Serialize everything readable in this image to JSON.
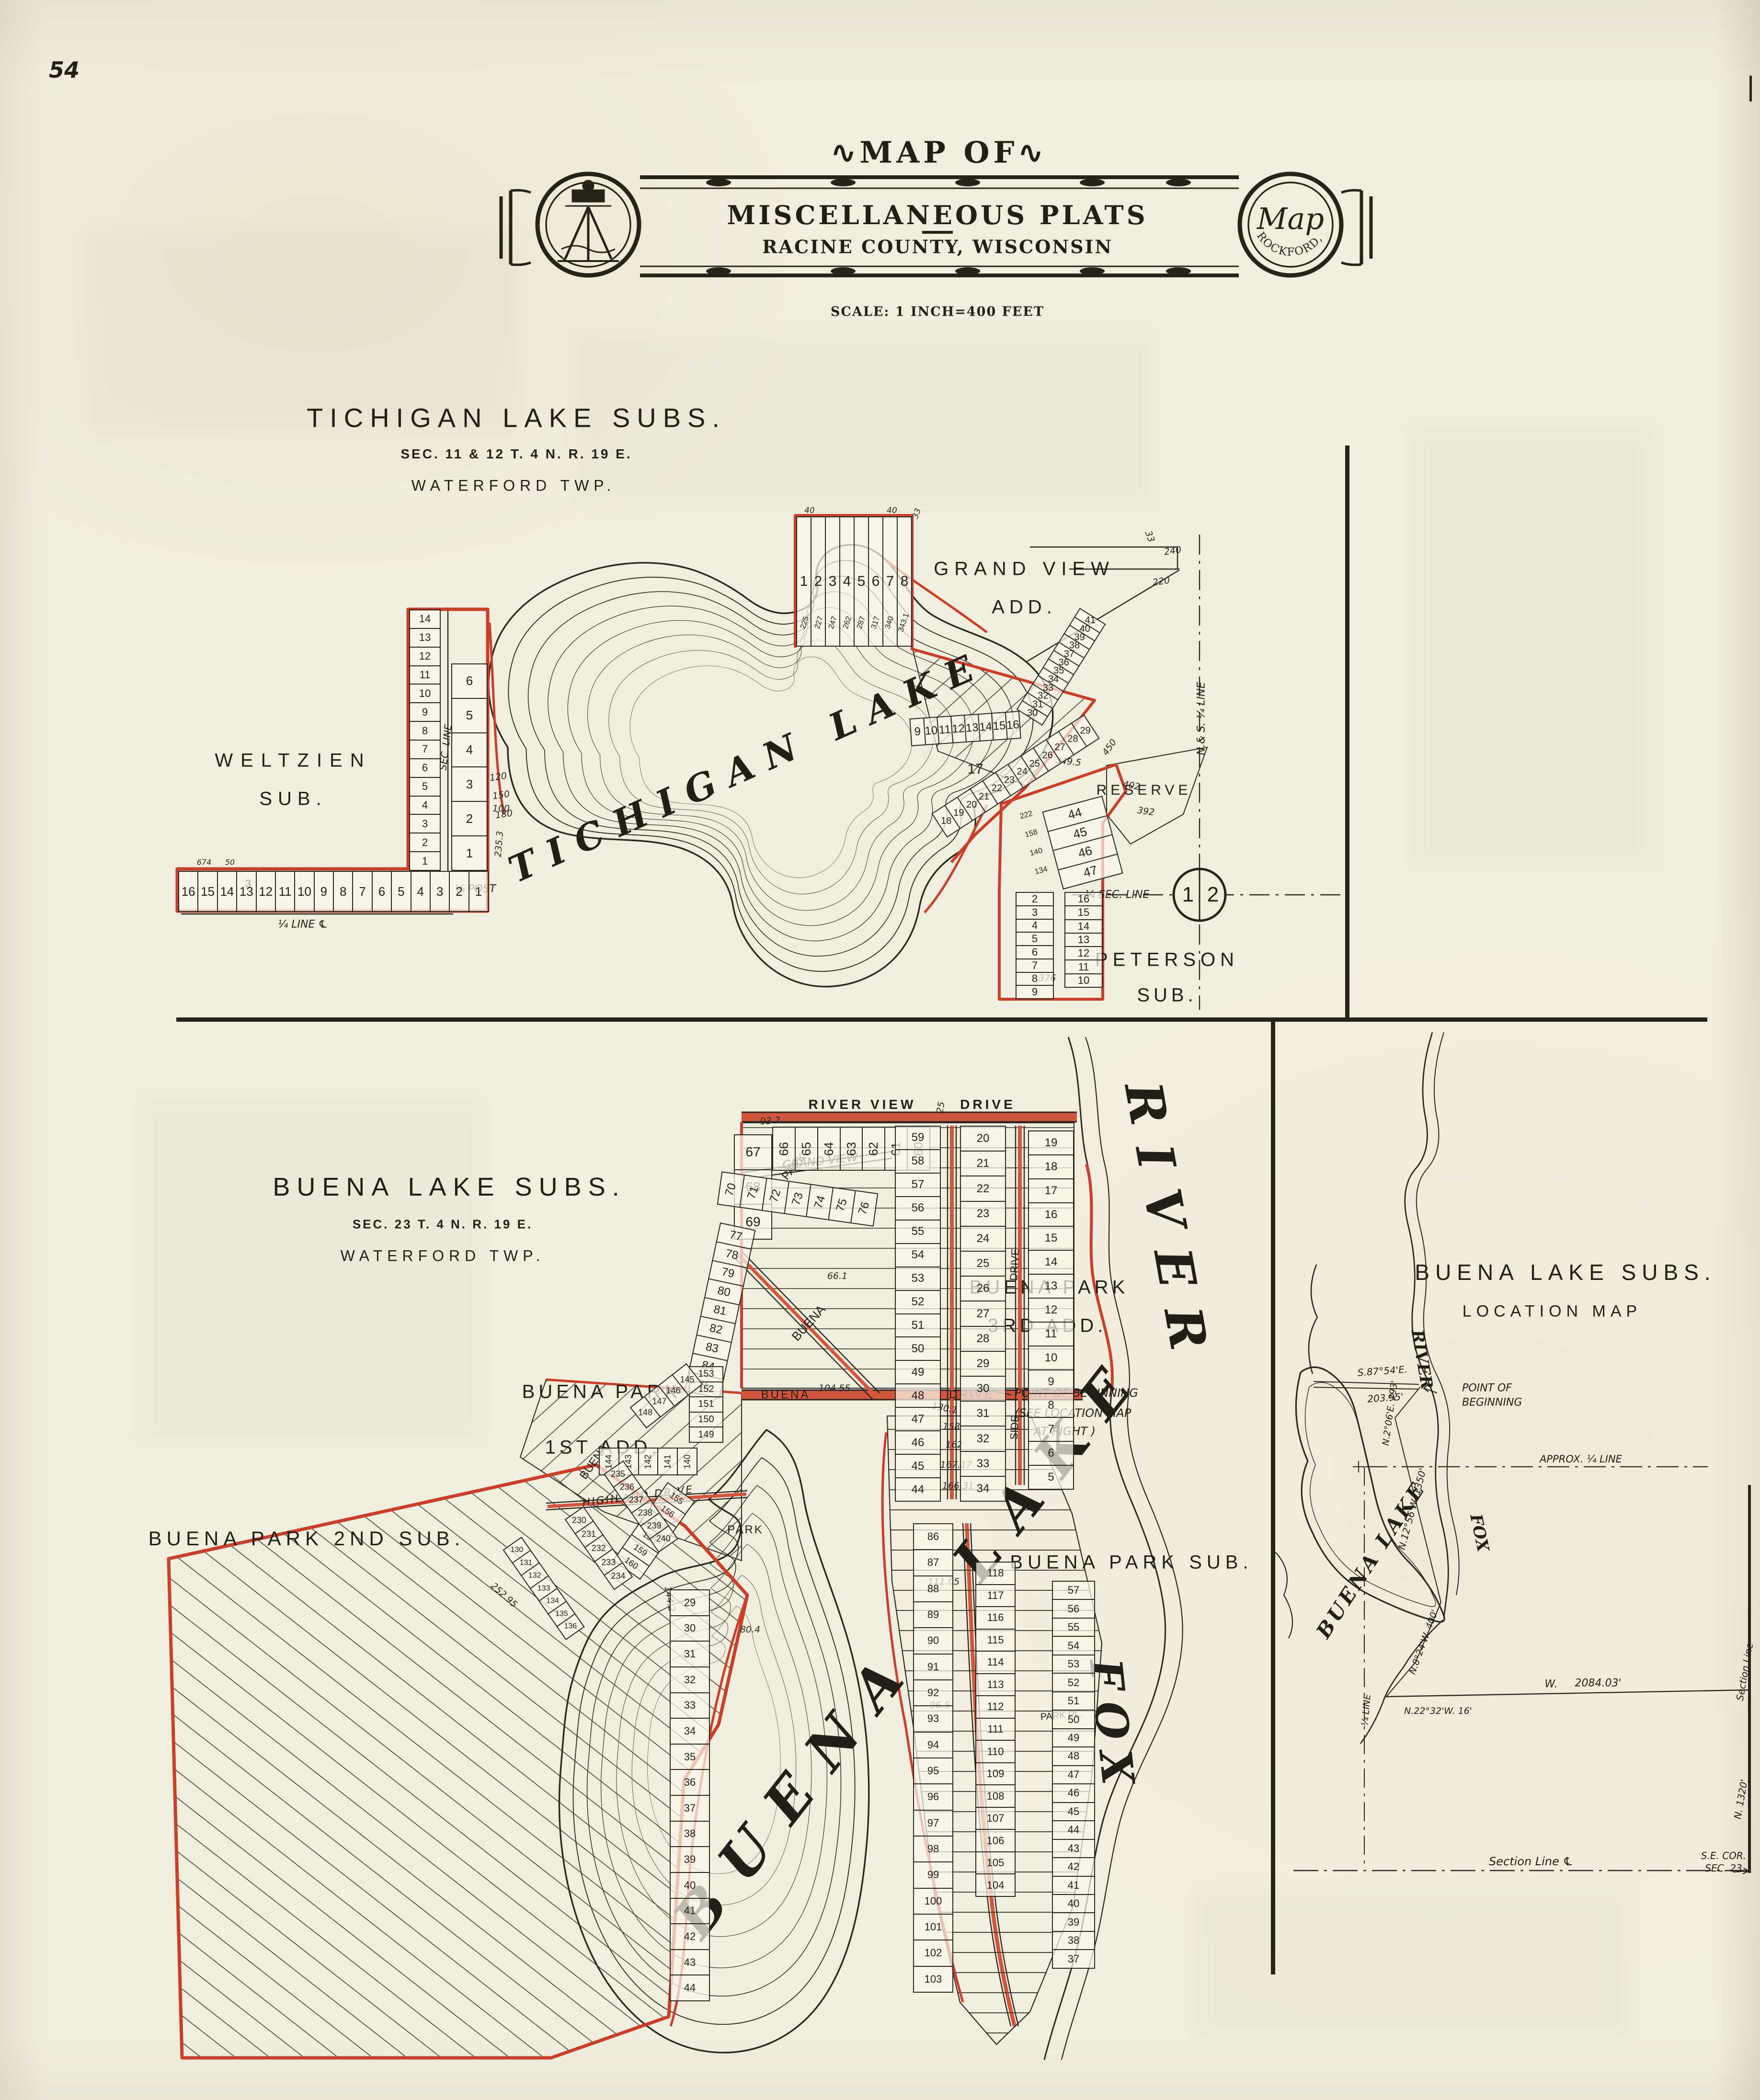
{
  "page": {
    "number": "54"
  },
  "header": {
    "flourish": "∿",
    "map_of": "MAP OF",
    "title": "MISCELLANEOUS PLATS",
    "subtitle": "RACINE COUNTY, WISCONSIN",
    "scale": "SCALE: 1 INCH=400 FEET",
    "seal_script": "Map",
    "seal_arc": "ROCKFORD, ILL."
  },
  "tichigan": {
    "title": "TICHIGAN LAKE SUBS.",
    "section": "SEC. 11 & 12   T. 4 N.   R. 19 E.",
    "township": "WATERFORD TWP.",
    "lake": "TICHIGAN LAKE",
    "weltzien_1": "WELTZIEN",
    "weltzien_2": "SUB.",
    "grand_view_1": "GRAND VIEW",
    "grand_view_2": "ADD.",
    "peterson_1": "PETERSON",
    "peterson_2": "SUB.",
    "reserve": "RESERVE",
    "quarter_line": "¼ LINE ℄",
    "quarter_post": "¼ POST",
    "sec_line": "SEC. LINE",
    "quarter_sec_line": "¼ SEC. LINE",
    "ns_quarter_line": "N.& S. ¼ LINE",
    "circle_1": "1",
    "circle_2": "2",
    "lot_17": "17",
    "weltzien_row": [
      "16",
      "15",
      "14",
      "13",
      "12",
      "11",
      "10",
      "9",
      "8",
      "7",
      "6",
      "5",
      "4",
      "3",
      "2",
      "1"
    ],
    "weltzien_block": "3",
    "weltzien_colA": [
      "14",
      "13",
      "12",
      "11",
      "10",
      "9",
      "8",
      "7",
      "6",
      "5",
      "4",
      "3",
      "2",
      "1"
    ],
    "weltzien_colB": [
      "6",
      "5",
      "4",
      "3",
      "2",
      "1"
    ],
    "gv_top": [
      "1",
      "2",
      "3",
      "4",
      "5",
      "6",
      "7",
      "8"
    ],
    "gv_top_dims": [
      "225",
      "227",
      "247",
      "262",
      "287",
      "317",
      "340",
      "343.1"
    ],
    "gv_mid": [
      "9",
      "10",
      "11",
      "12",
      "13",
      "14",
      "15",
      "16"
    ],
    "gv_fan": [
      "30",
      "31",
      "32",
      "33",
      "34",
      "35",
      "36",
      "37",
      "38",
      "39",
      "40",
      "41"
    ],
    "gv_shore": [
      "18",
      "19",
      "20",
      "21",
      "22",
      "23",
      "24",
      "25",
      "26",
      "27",
      "28",
      "29"
    ],
    "pet_top": [
      "44",
      "45",
      "46",
      "47"
    ],
    "pet_top_dims": [
      "222",
      "158",
      "140",
      "134"
    ],
    "pet_colA": [
      "2",
      "3",
      "4",
      "5",
      "6",
      "7",
      "8",
      "9"
    ],
    "pet_colB": [
      "16",
      "15",
      "14",
      "13",
      "12",
      "11",
      "10"
    ],
    "dims": [
      "240",
      "220",
      "33",
      "402",
      "392",
      "376",
      "450",
      "349.5",
      "100",
      "235.3",
      "120",
      "150",
      "180",
      "674",
      "50",
      "40",
      "33",
      "40"
    ]
  },
  "buena": {
    "title": "BUENA LAKE SUBS.",
    "section": "SEC. 23   T. 4 N.   R. 19 E.",
    "township": "WATERFORD TWP.",
    "lake_label": "BUENA LAKE",
    "river_fox": "FOX",
    "river_river": "RIVER",
    "first_add_1": "BUENA PARK",
    "first_add_2": "1ST ADD.",
    "second_sub": "BUENA PARK 2ND SUB.",
    "third_add_1": "BUENA PARK",
    "third_add_2": "3RD ADD.",
    "park_sub": "BUENA PARK SUB.",
    "park": "PARK",
    "park_pl": "PARK PL.",
    "st_river_view": "RIVER VIEW",
    "st_drive": "DRIVE",
    "st_grand_view": "GRAND VIEW",
    "st_highland": "HIGHLAND DRIVE",
    "st_buena": "BUENA",
    "st_buena_diag": "BUENA",
    "st_side": "SIDE",
    "st_side_drive": "DRIVE",
    "pob_1": "POINT OF BEGINNING",
    "pob_2": "(SEE LOCATION MAP",
    "pob_3": "AT RIGHT )",
    "row_60s": [
      "66",
      "65",
      "64",
      "63",
      "62",
      "61",
      "60"
    ],
    "col_67s": [
      "67",
      "68",
      "69"
    ],
    "colA": [
      "59",
      "58",
      "57",
      "56",
      "55",
      "54",
      "53",
      "52",
      "51",
      "50",
      "49",
      "48",
      "47",
      "46",
      "45",
      "44"
    ],
    "colB": [
      "20",
      "21",
      "22",
      "23",
      "24",
      "25",
      "26",
      "27",
      "28",
      "29",
      "30",
      "31",
      "32",
      "33",
      "34"
    ],
    "colC": [
      "19",
      "18",
      "17",
      "16",
      "15",
      "14",
      "13",
      "12",
      "11",
      "10",
      "9",
      "8",
      "7",
      "6",
      "5"
    ],
    "row_70s": [
      "70",
      "71",
      "72",
      "73",
      "74",
      "75",
      "76"
    ],
    "col_77s": [
      "77",
      "78",
      "79",
      "80",
      "81",
      "82",
      "83",
      "84",
      "85"
    ],
    "fa_colA": [
      "153",
      "152",
      "151",
      "150",
      "149"
    ],
    "fa_diag": [
      "148",
      "147",
      "146",
      "145"
    ],
    "fa_row": [
      "144",
      "143",
      "142",
      "141",
      "140"
    ],
    "fa_mid": [
      "155",
      "156",
      "157",
      "158",
      "159",
      "160"
    ],
    "ss_diagA": [
      "235",
      "236",
      "237",
      "238",
      "239",
      "240"
    ],
    "ss_diagB": [
      "230",
      "231",
      "232",
      "233",
      "234"
    ],
    "ss_diagC": [
      "130",
      "131",
      "132",
      "133",
      "134",
      "135",
      "136"
    ],
    "ss_colE": [
      "29",
      "30",
      "31",
      "32",
      "33",
      "34",
      "35",
      "36",
      "37",
      "38",
      "39",
      "40",
      "41",
      "42",
      "43",
      "44"
    ],
    "pen_colA": [
      "86",
      "87",
      "88",
      "89",
      "90",
      "91",
      "92",
      "93",
      "94",
      "95",
      "96",
      "97",
      "98",
      "99",
      "100",
      "101",
      "102",
      "103"
    ],
    "pen_colB": [
      "118",
      "117",
      "116",
      "115",
      "114",
      "113",
      "112",
      "111",
      "110",
      "109",
      "108",
      "107",
      "106",
      "105",
      "104"
    ],
    "pen_colC": [
      "57",
      "56",
      "55",
      "54",
      "53",
      "52",
      "51",
      "50",
      "49",
      "48",
      "47",
      "46",
      "45",
      "44",
      "43",
      "42",
      "41",
      "40",
      "39",
      "38",
      "37"
    ],
    "dims": [
      "93 2",
      "25",
      "66.1",
      "100",
      "104.55",
      "130.1",
      "158",
      "162",
      "167.17",
      "166.31",
      "252.95",
      "144.2",
      "80.4",
      "96.5",
      "111.05"
    ]
  },
  "location": {
    "title": "BUENA LAKE SUBS.",
    "subtitle": "LOCATION MAP",
    "lake": "BUENA LAKE",
    "fox": "FOX",
    "river": "RIVER",
    "pob_1": "POINT OF",
    "pob_2": "BEGINNING",
    "tie": "S.87°54'E.",
    "tie_dist": "203.95'",
    "b1": "N.2°06'E. 293'",
    "b2": "N.12°56'W. 1350'",
    "b3": "N.8°24'W. 400'",
    "b4": "N.22°32'W. 16'",
    "w_label": "W.",
    "w_dist": "2084.03'",
    "n_dist": "N. 1320'",
    "approx": "APPROX. ¼ LINE",
    "sec_line_bottom": "Section Line ℄",
    "sec_line_right": "Section Line",
    "quarter_line": "¼ LINE",
    "se_cor_1": "S.E. COR.",
    "se_cor_2": "SEC. 23"
  }
}
